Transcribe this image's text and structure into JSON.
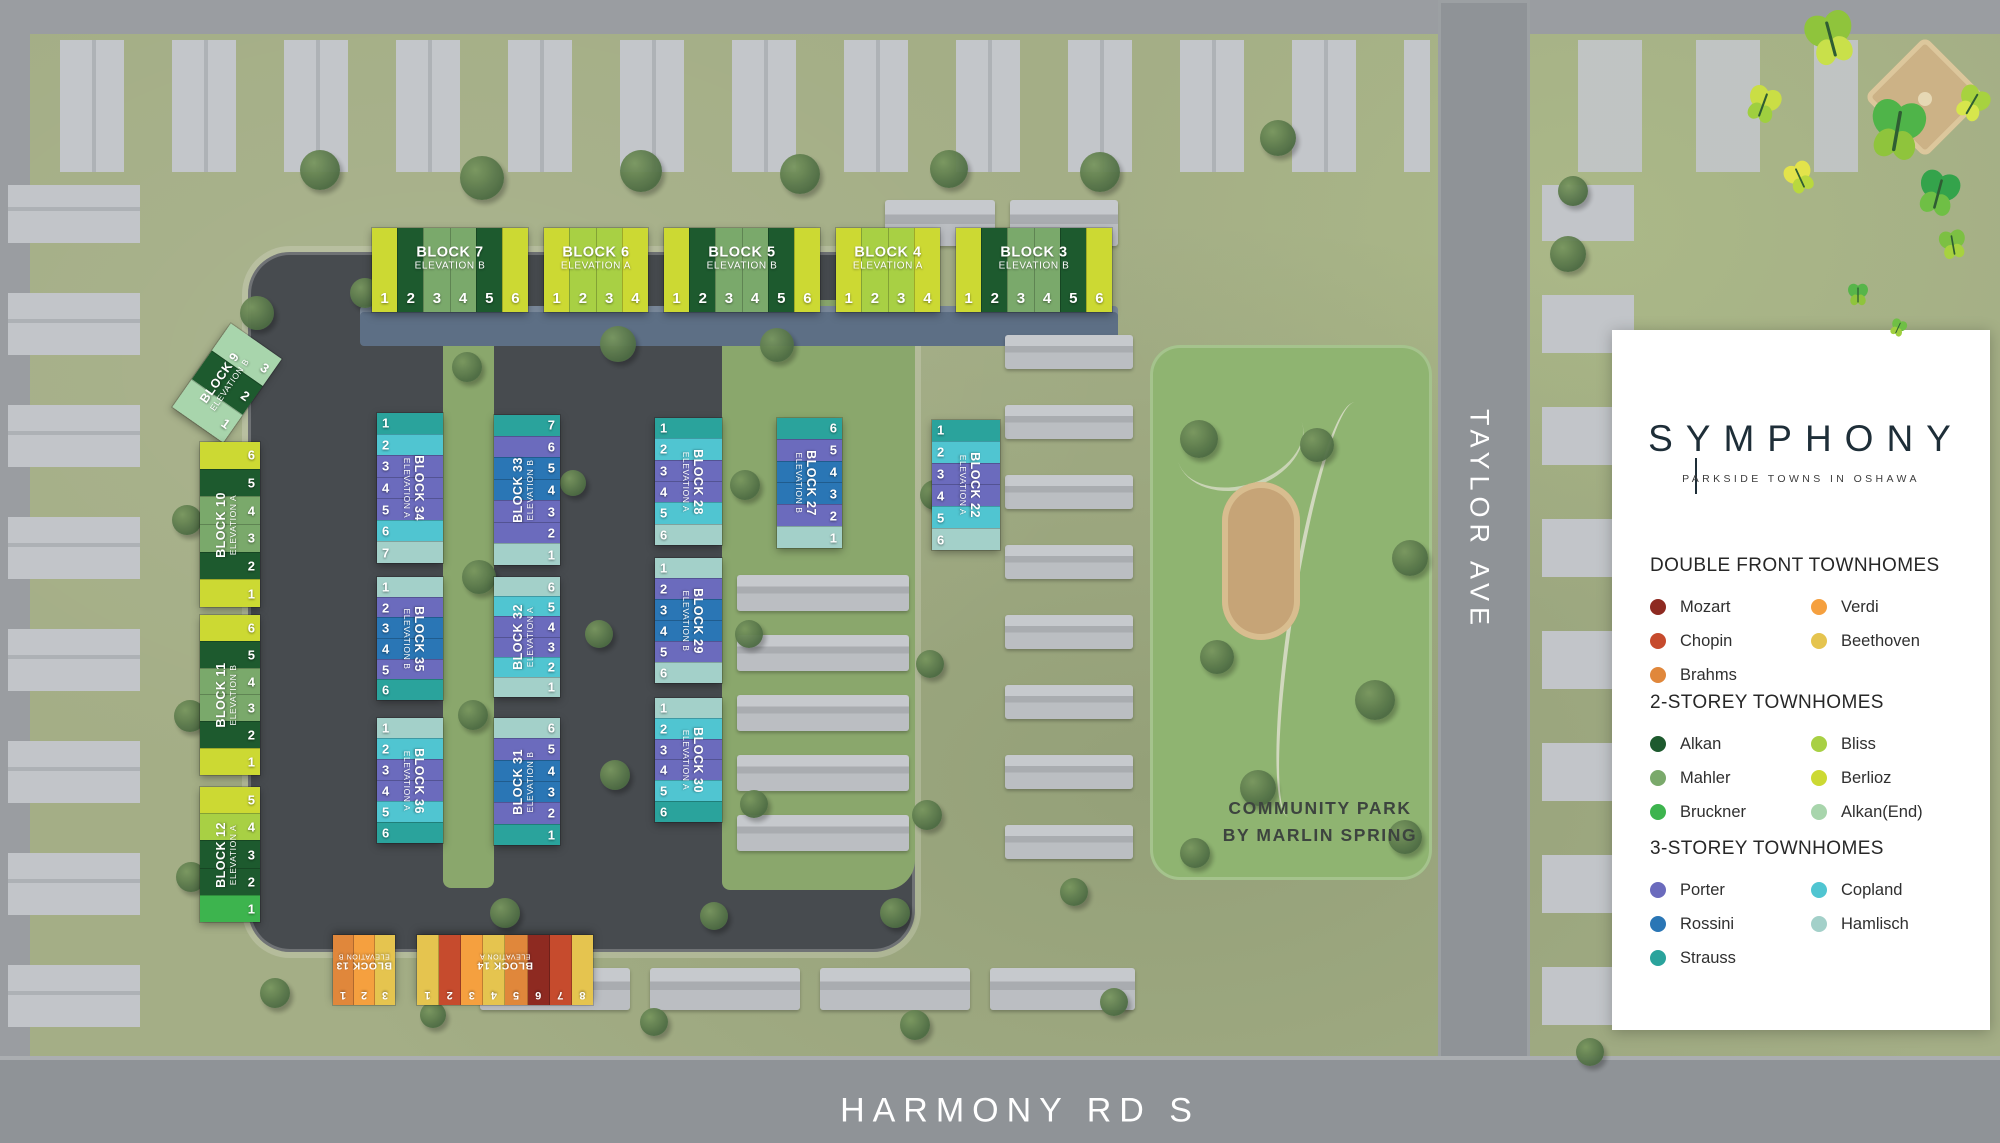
{
  "branding": {
    "logo": "SYMPHONY",
    "tagline": "PARKSIDE TOWNS IN OSHAWA"
  },
  "streets": {
    "taylor": "TAYLOR AVE",
    "harmony": "HARMONY RD S"
  },
  "park": {
    "line1": "COMMUNITY PARK",
    "line2": "BY MARLIN SPRING"
  },
  "palette": {
    "Mozart": "#8e2a21",
    "Chopin": "#c64b2d",
    "Brahms": "#e0873b",
    "Verdi": "#f5a03f",
    "Beethoven": "#e5c44f",
    "Alkan": "#1d5a2e",
    "Mahler": "#7aa96b",
    "Bruckner": "#3db44e",
    "Bliss": "#a8d044",
    "Berlioz": "#ccd933",
    "Alkan(End)": "#a8d5ac",
    "Porter": "#6b6bbd",
    "Rossini": "#2a76b5",
    "Strauss": "#2aa39c",
    "Copland": "#50c5d1",
    "Hamlisch": "#a3d0c9"
  },
  "legend": {
    "sections": [
      {
        "title": "DOUBLE FRONT TOWNHOMES",
        "columns": [
          [
            "Mozart",
            "Chopin",
            "Brahms"
          ],
          [
            "Verdi",
            "Beethoven"
          ]
        ]
      },
      {
        "title": "2-STOREY TOWNHOMES",
        "columns": [
          [
            "Alkan",
            "Mahler",
            "Bruckner"
          ],
          [
            "Bliss",
            "Berlioz",
            "Alkan(End)"
          ]
        ]
      },
      {
        "title": "3-STOREY TOWNHOMES",
        "columns": [
          [
            "Porter",
            "Rossini",
            "Strauss"
          ],
          [
            "Copland",
            "Hamlisch"
          ]
        ]
      }
    ]
  },
  "blocks": [
    {
      "id": "block-7",
      "label": "BLOCK 7",
      "elevation": "ELEVATION B",
      "x": 372,
      "y": 228,
      "w": 156,
      "h": 84,
      "dir": "row",
      "num": "bottom",
      "lrot": "h",
      "units": [
        {
          "n": "1",
          "c": "Berlioz"
        },
        {
          "n": "2",
          "c": "Alkan"
        },
        {
          "n": "3",
          "c": "Mahler"
        },
        {
          "n": "4",
          "c": "Mahler"
        },
        {
          "n": "5",
          "c": "Alkan"
        },
        {
          "n": "6",
          "c": "Berlioz"
        }
      ]
    },
    {
      "id": "block-6",
      "label": "BLOCK 6",
      "elevation": "ELEVATION A",
      "x": 544,
      "y": 228,
      "w": 104,
      "h": 84,
      "dir": "row",
      "num": "bottom",
      "lrot": "h",
      "units": [
        {
          "n": "1",
          "c": "Berlioz"
        },
        {
          "n": "2",
          "c": "Bliss"
        },
        {
          "n": "3",
          "c": "Bliss"
        },
        {
          "n": "4",
          "c": "Berlioz"
        }
      ]
    },
    {
      "id": "block-5",
      "label": "BLOCK 5",
      "elevation": "ELEVATION B",
      "x": 664,
      "y": 228,
      "w": 156,
      "h": 84,
      "dir": "row",
      "num": "bottom",
      "lrot": "h",
      "units": [
        {
          "n": "1",
          "c": "Berlioz"
        },
        {
          "n": "2",
          "c": "Alkan"
        },
        {
          "n": "3",
          "c": "Mahler"
        },
        {
          "n": "4",
          "c": "Mahler"
        },
        {
          "n": "5",
          "c": "Alkan"
        },
        {
          "n": "6",
          "c": "Berlioz"
        }
      ]
    },
    {
      "id": "block-4",
      "label": "BLOCK 4",
      "elevation": "ELEVATION A",
      "x": 836,
      "y": 228,
      "w": 104,
      "h": 84,
      "dir": "row",
      "num": "bottom",
      "lrot": "h",
      "units": [
        {
          "n": "1",
          "c": "Berlioz"
        },
        {
          "n": "2",
          "c": "Bliss"
        },
        {
          "n": "3",
          "c": "Bliss"
        },
        {
          "n": "4",
          "c": "Berlioz"
        }
      ]
    },
    {
      "id": "block-3",
      "label": "BLOCK 3",
      "elevation": "ELEVATION B",
      "x": 956,
      "y": 228,
      "w": 156,
      "h": 84,
      "dir": "row",
      "num": "bottom",
      "lrot": "h",
      "units": [
        {
          "n": "1",
          "c": "Berlioz"
        },
        {
          "n": "2",
          "c": "Alkan"
        },
        {
          "n": "3",
          "c": "Mahler"
        },
        {
          "n": "4",
          "c": "Mahler"
        },
        {
          "n": "5",
          "c": "Alkan"
        },
        {
          "n": "6",
          "c": "Berlioz"
        }
      ]
    },
    {
      "id": "block-9",
      "label": "BLOCK 9",
      "elevation": "ELEVATION B",
      "x": 196,
      "y": 332,
      "w": 62,
      "h": 102,
      "dir": "col",
      "num": "right",
      "lrot": "ccw",
      "rot": 35,
      "units": [
        {
          "n": "3",
          "c": "Alkan(End)"
        },
        {
          "n": "2",
          "c": "Alkan"
        },
        {
          "n": "1",
          "c": "Alkan(End)"
        }
      ]
    },
    {
      "id": "block-10",
      "label": "BLOCK 10",
      "elevation": "ELEVATION A",
      "x": 200,
      "y": 442,
      "w": 60,
      "h": 165,
      "dir": "col",
      "num": "right",
      "lrot": "ccw",
      "units": [
        {
          "n": "6",
          "c": "Berlioz"
        },
        {
          "n": "5",
          "c": "Alkan"
        },
        {
          "n": "4",
          "c": "Mahler"
        },
        {
          "n": "3",
          "c": "Mahler"
        },
        {
          "n": "2",
          "c": "Alkan"
        },
        {
          "n": "1",
          "c": "Berlioz"
        }
      ]
    },
    {
      "id": "block-11",
      "label": "BLOCK 11",
      "elevation": "ELEVATION B",
      "x": 200,
      "y": 615,
      "w": 60,
      "h": 160,
      "dir": "col",
      "num": "right",
      "lrot": "ccw",
      "units": [
        {
          "n": "6",
          "c": "Berlioz"
        },
        {
          "n": "5",
          "c": "Alkan"
        },
        {
          "n": "4",
          "c": "Mahler"
        },
        {
          "n": "3",
          "c": "Mahler"
        },
        {
          "n": "2",
          "c": "Alkan"
        },
        {
          "n": "1",
          "c": "Berlioz"
        }
      ]
    },
    {
      "id": "block-12",
      "label": "BLOCK 12",
      "elevation": "ELEVATION A",
      "x": 200,
      "y": 787,
      "w": 60,
      "h": 135,
      "dir": "col",
      "num": "right",
      "lrot": "ccw",
      "units": [
        {
          "n": "5",
          "c": "Berlioz"
        },
        {
          "n": "4",
          "c": "Bliss"
        },
        {
          "n": "3",
          "c": "Alkan"
        },
        {
          "n": "2",
          "c": "Alkan"
        },
        {
          "n": "1",
          "c": "Bruckner"
        }
      ]
    },
    {
      "id": "block-34",
      "label": "BLOCK 34",
      "elevation": "ELEVATION A",
      "x": 377,
      "y": 413,
      "w": 66,
      "h": 150,
      "dir": "col",
      "num": "left",
      "lrot": "cw",
      "units": [
        {
          "n": "1",
          "c": "Strauss"
        },
        {
          "n": "2",
          "c": "Copland"
        },
        {
          "n": "3",
          "c": "Porter"
        },
        {
          "n": "4",
          "c": "Porter"
        },
        {
          "n": "5",
          "c": "Porter"
        },
        {
          "n": "6",
          "c": "Copland"
        },
        {
          "n": "7",
          "c": "Hamlisch"
        }
      ]
    },
    {
      "id": "block-35",
      "label": "BLOCK 35",
      "elevation": "ELEVATION B",
      "x": 377,
      "y": 577,
      "w": 66,
      "h": 123,
      "dir": "col",
      "num": "left",
      "lrot": "cw",
      "units": [
        {
          "n": "1",
          "c": "Hamlisch"
        },
        {
          "n": "2",
          "c": "Porter"
        },
        {
          "n": "3",
          "c": "Rossini"
        },
        {
          "n": "4",
          "c": "Rossini"
        },
        {
          "n": "5",
          "c": "Porter"
        },
        {
          "n": "6",
          "c": "Strauss"
        }
      ]
    },
    {
      "id": "block-36",
      "label": "BLOCK 36",
      "elevation": "ELEVATION A",
      "x": 377,
      "y": 718,
      "w": 66,
      "h": 125,
      "dir": "col",
      "num": "left",
      "lrot": "cw",
      "units": [
        {
          "n": "1",
          "c": "Hamlisch"
        },
        {
          "n": "2",
          "c": "Copland"
        },
        {
          "n": "3",
          "c": "Porter"
        },
        {
          "n": "4",
          "c": "Porter"
        },
        {
          "n": "5",
          "c": "Copland"
        },
        {
          "n": "6",
          "c": "Strauss"
        }
      ]
    },
    {
      "id": "block-33",
      "label": "BLOCK 33",
      "elevation": "ELEVATION B",
      "x": 494,
      "y": 415,
      "w": 66,
      "h": 150,
      "dir": "col",
      "num": "right",
      "lrot": "ccw",
      "units": [
        {
          "n": "7",
          "c": "Strauss"
        },
        {
          "n": "6",
          "c": "Porter"
        },
        {
          "n": "5",
          "c": "Rossini"
        },
        {
          "n": "4",
          "c": "Rossini"
        },
        {
          "n": "3",
          "c": "Porter"
        },
        {
          "n": "2",
          "c": "Porter"
        },
        {
          "n": "1",
          "c": "Hamlisch"
        }
      ]
    },
    {
      "id": "block-32",
      "label": "BLOCK 32",
      "elevation": "ELEVATION A",
      "x": 494,
      "y": 577,
      "w": 66,
      "h": 120,
      "dir": "col",
      "num": "right",
      "lrot": "ccw",
      "units": [
        {
          "n": "6",
          "c": "Hamlisch"
        },
        {
          "n": "5",
          "c": "Copland"
        },
        {
          "n": "4",
          "c": "Porter"
        },
        {
          "n": "3",
          "c": "Porter"
        },
        {
          "n": "2",
          "c": "Copland"
        },
        {
          "n": "1",
          "c": "Hamlisch"
        }
      ]
    },
    {
      "id": "block-31",
      "label": "BLOCK 31",
      "elevation": "ELEVATION B",
      "x": 494,
      "y": 718,
      "w": 66,
      "h": 127,
      "dir": "col",
      "num": "right",
      "lrot": "ccw",
      "units": [
        {
          "n": "6",
          "c": "Hamlisch"
        },
        {
          "n": "5",
          "c": "Porter"
        },
        {
          "n": "4",
          "c": "Rossini"
        },
        {
          "n": "3",
          "c": "Rossini"
        },
        {
          "n": "2",
          "c": "Porter"
        },
        {
          "n": "1",
          "c": "Strauss"
        }
      ]
    },
    {
      "id": "block-28",
      "label": "BLOCK 28",
      "elevation": "ELEVATION A",
      "x": 655,
      "y": 418,
      "w": 67,
      "h": 127,
      "dir": "col",
      "num": "left",
      "lrot": "cw",
      "units": [
        {
          "n": "1",
          "c": "Strauss"
        },
        {
          "n": "2",
          "c": "Copland"
        },
        {
          "n": "3",
          "c": "Porter"
        },
        {
          "n": "4",
          "c": "Porter"
        },
        {
          "n": "5",
          "c": "Copland"
        },
        {
          "n": "6",
          "c": "Hamlisch"
        }
      ]
    },
    {
      "id": "block-29",
      "label": "BLOCK 29",
      "elevation": "ELEVATION B",
      "x": 655,
      "y": 558,
      "w": 67,
      "h": 125,
      "dir": "col",
      "num": "left",
      "lrot": "cw",
      "units": [
        {
          "n": "1",
          "c": "Hamlisch"
        },
        {
          "n": "2",
          "c": "Porter"
        },
        {
          "n": "3",
          "c": "Rossini"
        },
        {
          "n": "4",
          "c": "Rossini"
        },
        {
          "n": "5",
          "c": "Porter"
        },
        {
          "n": "6",
          "c": "Hamlisch"
        }
      ]
    },
    {
      "id": "block-30",
      "label": "BLOCK 30",
      "elevation": "ELEVATION A",
      "x": 655,
      "y": 698,
      "w": 67,
      "h": 124,
      "dir": "col",
      "num": "left",
      "lrot": "cw",
      "units": [
        {
          "n": "1",
          "c": "Hamlisch"
        },
        {
          "n": "2",
          "c": "Copland"
        },
        {
          "n": "3",
          "c": "Porter"
        },
        {
          "n": "4",
          "c": "Porter"
        },
        {
          "n": "5",
          "c": "Copland"
        },
        {
          "n": "6",
          "c": "Strauss"
        }
      ]
    },
    {
      "id": "block-27",
      "label": "BLOCK 27",
      "elevation": "ELEVATION B",
      "x": 777,
      "y": 418,
      "w": 65,
      "h": 130,
      "dir": "col",
      "num": "right",
      "lrot": "cw",
      "units": [
        {
          "n": "6",
          "c": "Strauss"
        },
        {
          "n": "5",
          "c": "Porter"
        },
        {
          "n": "4",
          "c": "Rossini"
        },
        {
          "n": "3",
          "c": "Rossini"
        },
        {
          "n": "2",
          "c": "Porter"
        },
        {
          "n": "1",
          "c": "Hamlisch"
        }
      ]
    },
    {
      "id": "block-22",
      "label": "BLOCK 22",
      "elevation": "ELEVATION A",
      "x": 932,
      "y": 420,
      "w": 68,
      "h": 130,
      "dir": "col",
      "num": "left",
      "lrot": "cw",
      "units": [
        {
          "n": "1",
          "c": "Strauss"
        },
        {
          "n": "2",
          "c": "Copland"
        },
        {
          "n": "3",
          "c": "Porter"
        },
        {
          "n": "4",
          "c": "Porter"
        },
        {
          "n": "5",
          "c": "Copland"
        },
        {
          "n": "6",
          "c": "Hamlisch"
        }
      ]
    },
    {
      "id": "block-13",
      "label": "BLOCK 13",
      "elevation": "ELEVATION B",
      "x": 333,
      "y": 935,
      "w": 62,
      "h": 70,
      "dir": "row",
      "num": "bottom",
      "lrot": "h",
      "rot": 180,
      "small": true,
      "units": [
        {
          "n": "3",
          "c": "Beethoven"
        },
        {
          "n": "2",
          "c": "Verdi"
        },
        {
          "n": "1",
          "c": "Brahms"
        }
      ]
    },
    {
      "id": "block-14",
      "label": "BLOCK 14",
      "elevation": "ELEVATION A",
      "x": 417,
      "y": 935,
      "w": 176,
      "h": 70,
      "dir": "row",
      "num": "bottom",
      "lrot": "h",
      "rot": 180,
      "small": true,
      "units": [
        {
          "n": "8",
          "c": "Beethoven"
        },
        {
          "n": "7",
          "c": "Chopin"
        },
        {
          "n": "6",
          "c": "Mozart"
        },
        {
          "n": "5",
          "c": "Brahms"
        },
        {
          "n": "4",
          "c": "Beethoven"
        },
        {
          "n": "3",
          "c": "Verdi"
        },
        {
          "n": "2",
          "c": "Chopin"
        },
        {
          "n": "1",
          "c": "Beethoven"
        }
      ]
    }
  ]
}
